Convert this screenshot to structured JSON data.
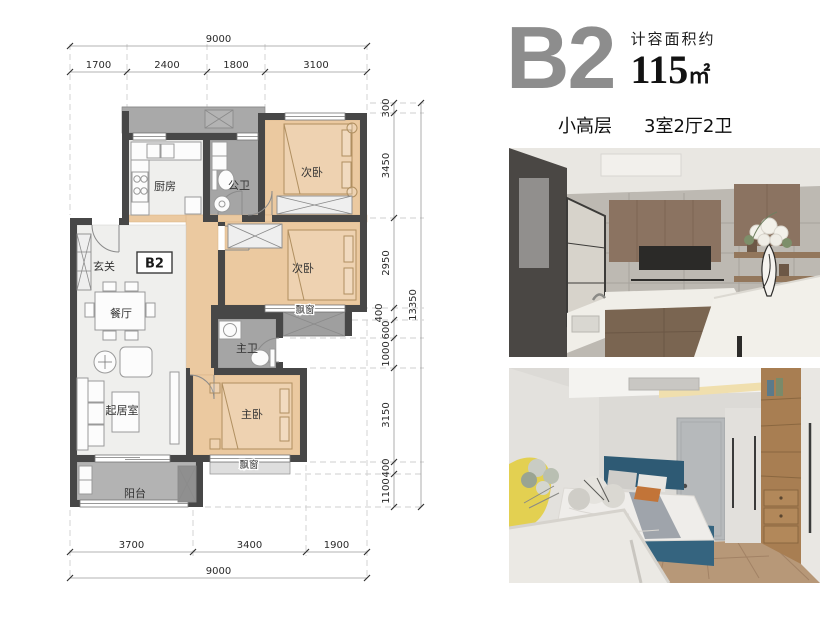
{
  "header": {
    "unit": "B2",
    "area_label": "计容面积约",
    "area_value": "115",
    "area_unit": "㎡",
    "building_type": "小高层",
    "rooms_spec": "3室2厅2卫"
  },
  "plan": {
    "badge": "B2",
    "rooms": {
      "kitchen": "厨房",
      "public_bath": "公卫",
      "bedroom_top": "次卧",
      "bedroom_mid": "次卧",
      "entry": "玄关",
      "dining": "餐厅",
      "living": "起居室",
      "master_bedroom": "主卧",
      "master_bath": "主卫",
      "balcony": "阳台",
      "bay_window_mid": "飘窗",
      "bay_window_bottom": "飘窗"
    },
    "dims": {
      "top_total": "9000",
      "top": [
        "1700",
        "2400",
        "1800",
        "3100"
      ],
      "right": [
        "300",
        "3450",
        "2950",
        "400",
        "600",
        "1000",
        "3150",
        "400",
        "1100"
      ],
      "right_total": "13350",
      "bottom": [
        "3700",
        "3400",
        "1900"
      ],
      "bottom_total": "9000"
    }
  },
  "colors": {
    "wall": "#474747",
    "wood_floor": "#ebc9a0",
    "tile_gray": "#a5a5a5",
    "unit_gray": "#8d8d8d",
    "text_dark": "#1c1c1c",
    "bed_blue": "#35647f",
    "chair_yellow": "#e3d051"
  }
}
